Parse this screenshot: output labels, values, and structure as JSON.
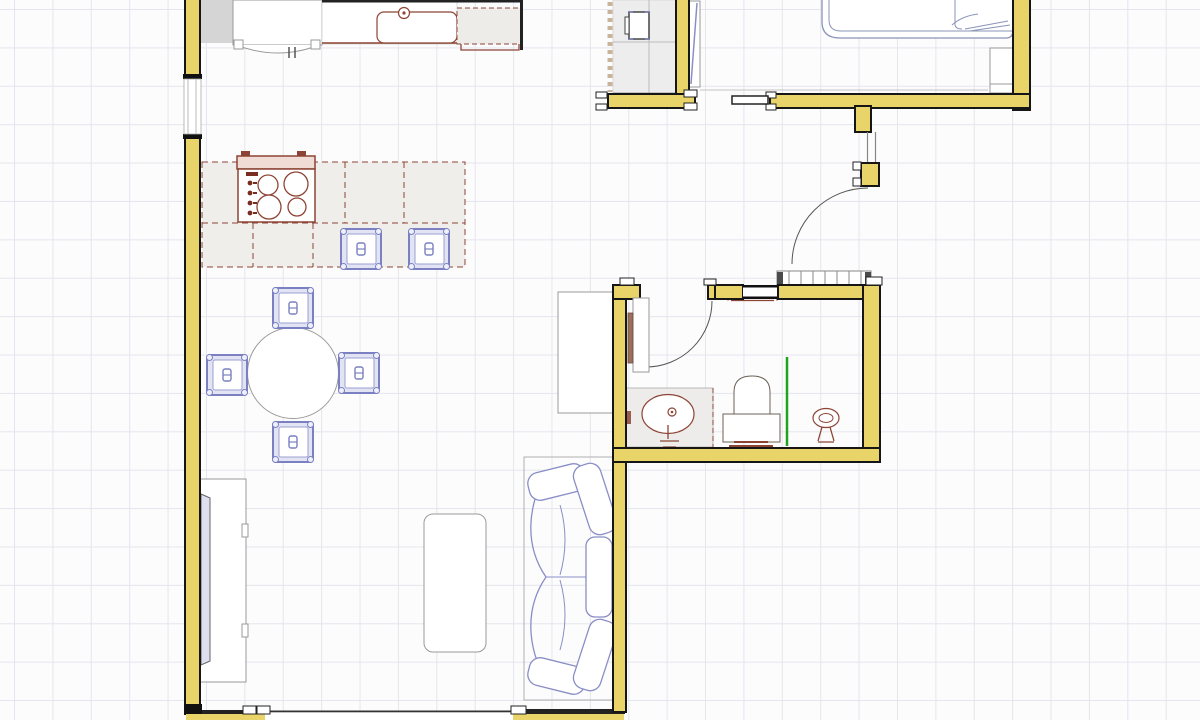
{
  "app": {
    "type": "floor-plan-editor",
    "document": "apartment-floor-plan",
    "view": "2d-top-view"
  },
  "canvas": {
    "width_px": 1200,
    "height_px": 720,
    "grid_cell_px": 38,
    "background_color": "#fcfcfc",
    "grid_line_color": "#e5e5ef"
  },
  "palette": {
    "wall_fill": "#e8d468",
    "wall_outline": "#161616",
    "kitchen_item_outline": "#8c4435",
    "soft_furniture_outline": "#7b80c2",
    "sofa_bed_outline": "#8a8ec6",
    "neutral_furniture_outline": "#9a9a9a",
    "towel_rail_green": "#1ea41e",
    "counter_fill": "#efeeea",
    "closet_fill": "#ededed",
    "appliance_block_gray": "#d5d5d5"
  },
  "rooms": [
    {
      "id": "kitchen",
      "name": "kitchen",
      "furniture": [
        "refrigerator",
        "sink-counter",
        "kitchen-sink",
        "faucet",
        "dishwasher",
        "kitchen-island",
        "gas-cooktop",
        "bar-stool",
        "bar-stool"
      ]
    },
    {
      "id": "dining-area",
      "name": "dining-area",
      "furniture": [
        "round-dining-table",
        "dining-chair",
        "dining-chair",
        "dining-chair",
        "dining-chair"
      ]
    },
    {
      "id": "living-room",
      "name": "living-room",
      "furniture": [
        "tv-cabinet",
        "television",
        "coffee-table",
        "sectional-sofa",
        "storage-cabinet"
      ]
    },
    {
      "id": "bathroom",
      "name": "bathroom",
      "furniture": [
        "vanity-counter",
        "wash-basin",
        "toilet",
        "towel-rail",
        "pedestal-stand",
        "radiator",
        "wall-shelf",
        "wall-dispenser"
      ]
    },
    {
      "id": "bedroom",
      "name": "bedroom",
      "furniture": [
        "double-bed",
        "nightstand"
      ]
    },
    {
      "id": "hall-closet",
      "name": "hall-closet",
      "furniture": [
        "wardrobe",
        "drawer-unit",
        "mirror-door-leaf"
      ]
    }
  ],
  "openings": {
    "doors": [
      {
        "room": "bathroom",
        "type": "hinged",
        "state": "open"
      },
      {
        "room": "hallway",
        "type": "hinged",
        "state": "open"
      },
      {
        "room": "bedroom",
        "type": "sliding",
        "state": "open"
      }
    ],
    "windows": [
      {
        "wall": "left"
      },
      {
        "wall": "bottom"
      },
      {
        "wall": "bathroom-top"
      }
    ]
  }
}
